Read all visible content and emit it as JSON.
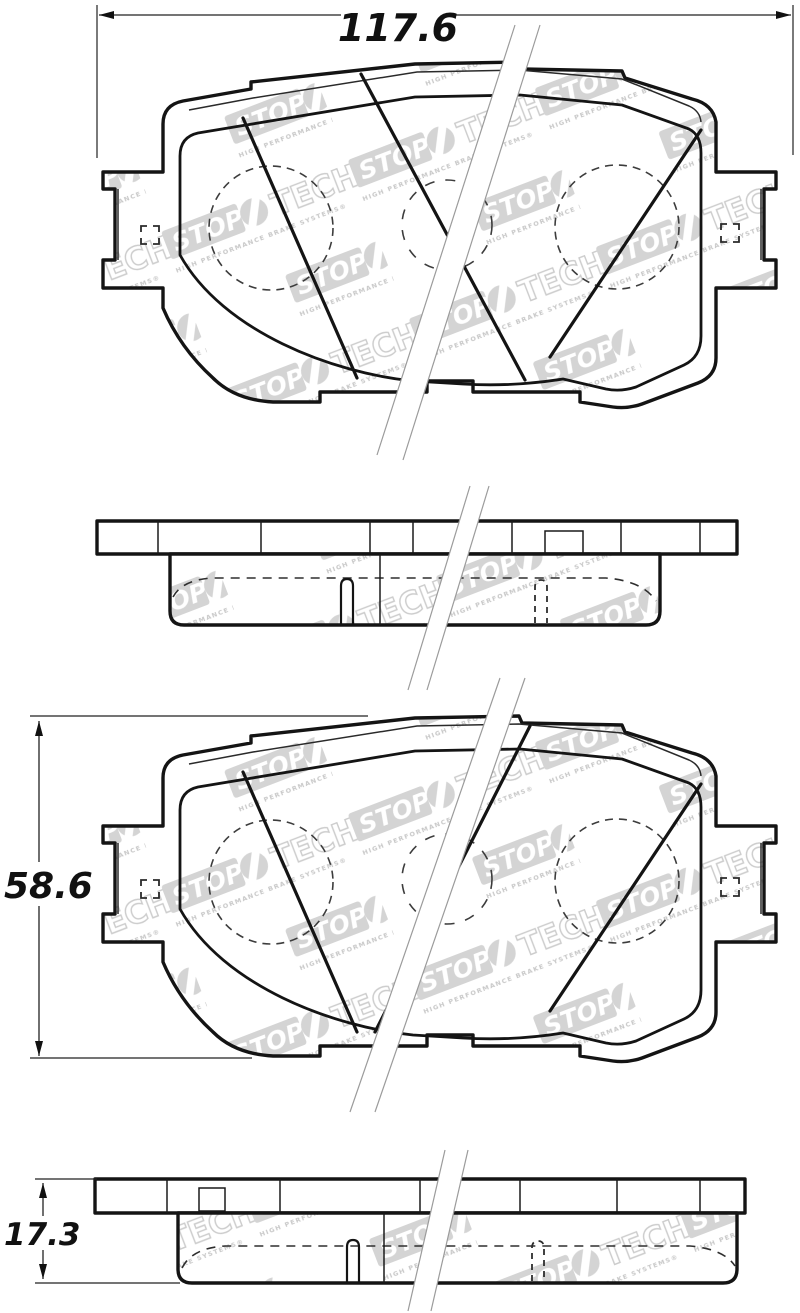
{
  "dimensions": {
    "overall_width": "117.6",
    "pad_height": "58.6",
    "pad_thickness": "17.3"
  },
  "watermark": {
    "stop": "STOP",
    "tech": "TECH",
    "tagline": "HIGH PERFORMANCE BRAKE SYSTEMS®"
  },
  "colors": {
    "line": "#141414",
    "watermark_gray": "#d4d4d4",
    "break_line": "#9b9b9b",
    "background": "#ffffff"
  }
}
